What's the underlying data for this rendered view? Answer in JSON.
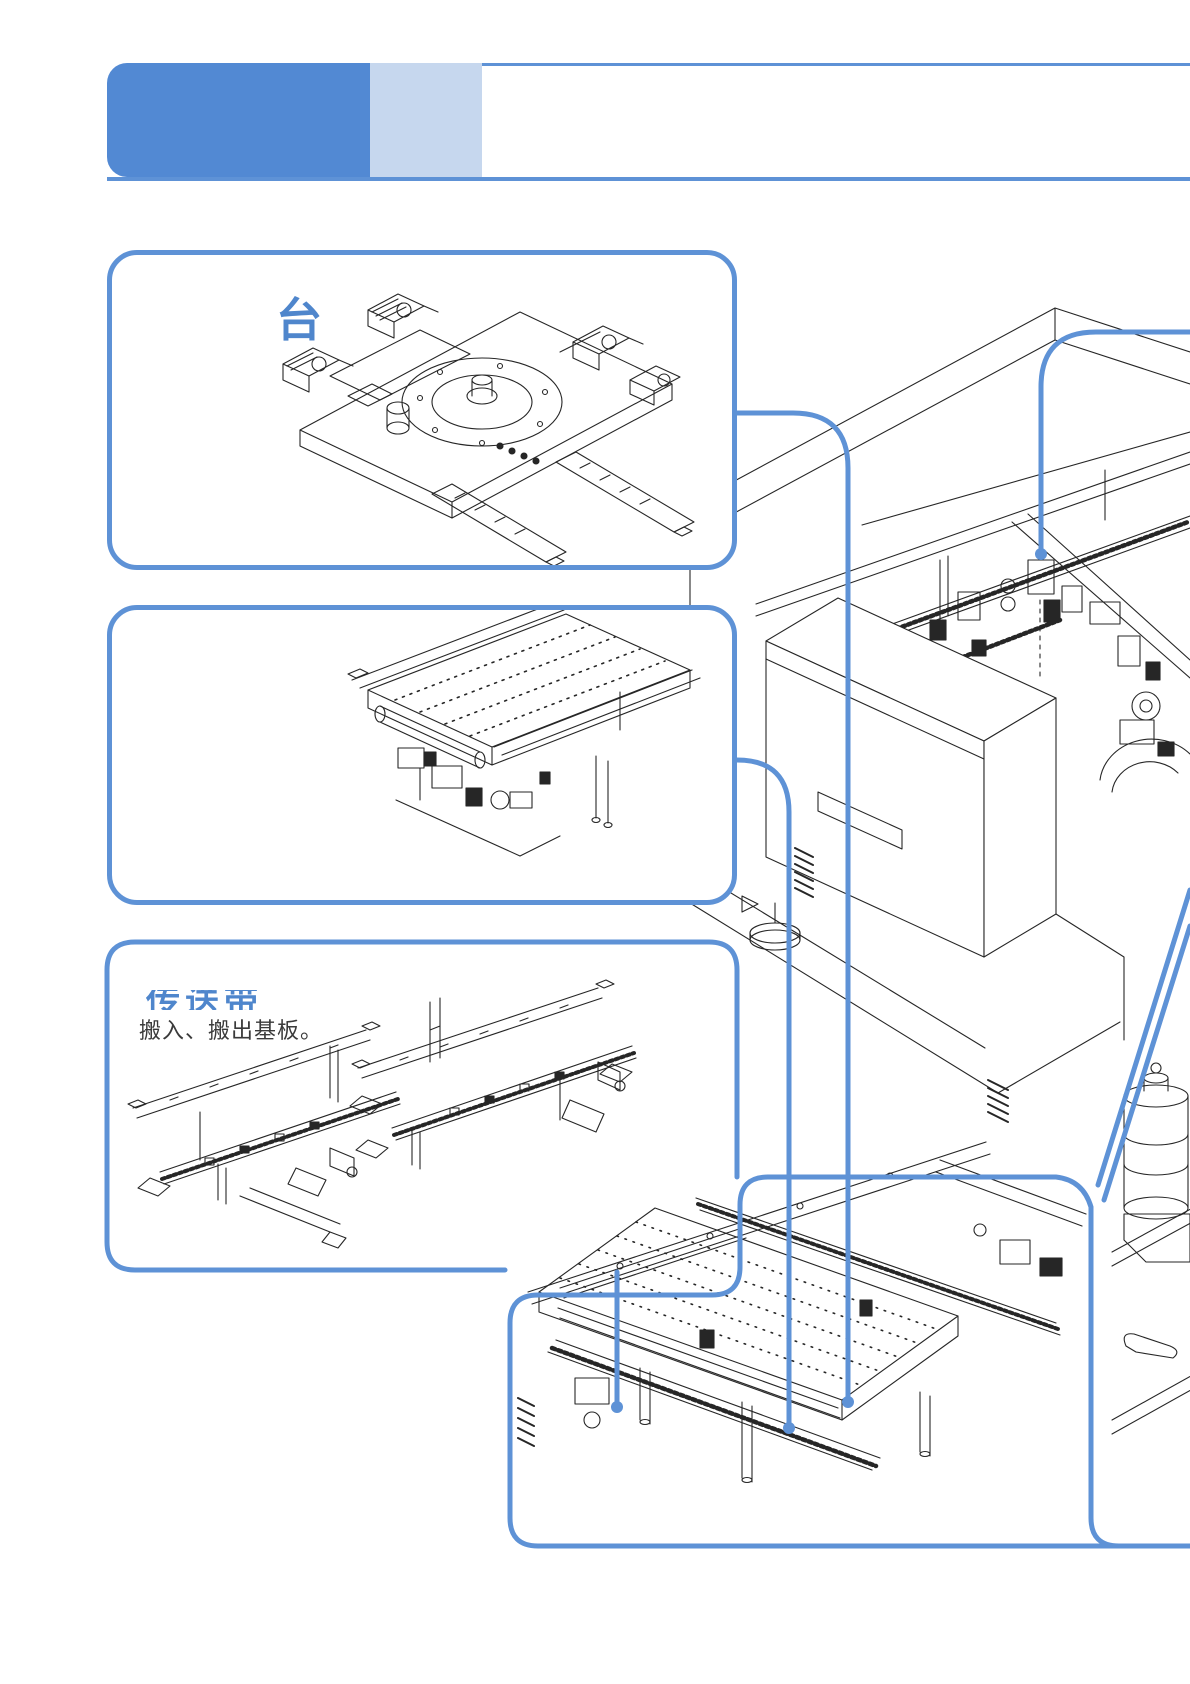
{
  "colors": {
    "accent_blue": "#5e92d6",
    "header_dark_blue": "#5289d3",
    "header_light_blue": "#c6d7ee",
    "title_text_blue": "#4f86cc",
    "drawing_ink": "#262626"
  },
  "callouts": {
    "rotary_stage": {
      "title": "台"
    },
    "conveyor": {
      "title": "传送带",
      "description": "搬入、搬出基板。"
    }
  },
  "illustrations": {
    "machine": "pick-and-place-machine-line-drawing",
    "rotary_stage": "rotary-stage-line-drawing",
    "transfer_table": "transfer-table-line-drawing",
    "conveyor_rails": "conveyor-rails-line-drawing",
    "board_conveyor_detail": "board-conveyor-detail-line-drawing"
  }
}
